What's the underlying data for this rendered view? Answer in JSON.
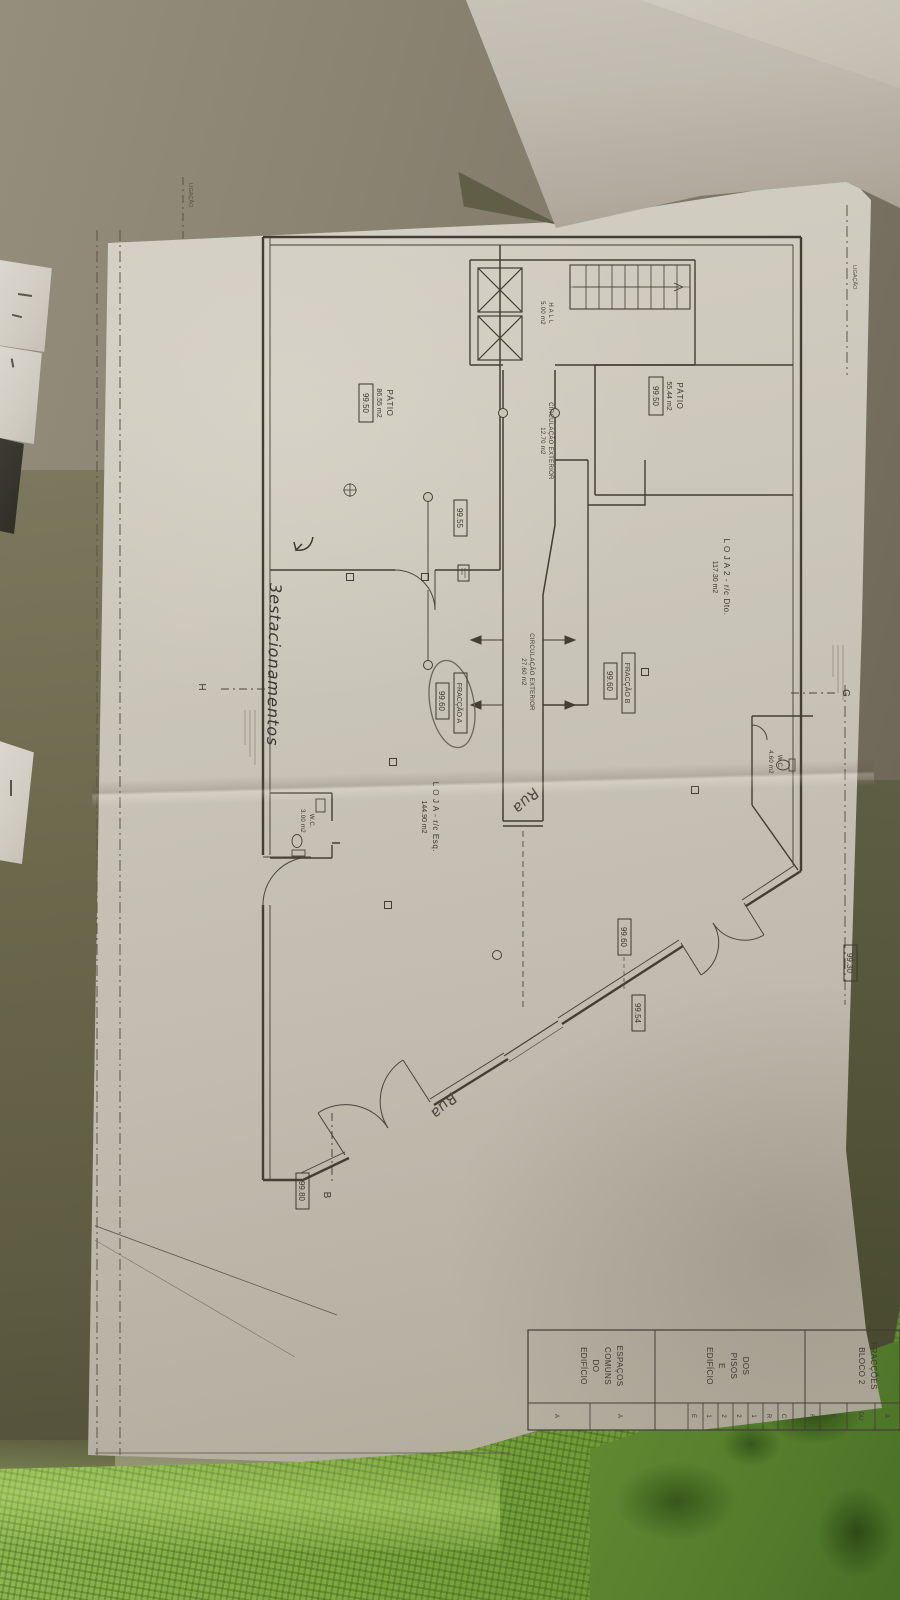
{
  "rooms": {
    "patio_top": {
      "name": "PÁTIO",
      "area": "55.44 m2",
      "level": "99.50"
    },
    "patio_left": {
      "name": "PÁTIO",
      "area": "86.55 m2",
      "level": "99.50"
    },
    "loja2": {
      "name": "L O J A 2 - r/c Dto.",
      "area": "117.30 m2"
    },
    "loja": {
      "name": "L O J A - r/c Esq.",
      "area": "144.90 m2"
    },
    "circulacao_1": {
      "name": "CIRCULAÇÃO EXTERIOR",
      "area": "12.70 m2"
    },
    "circulacao_2": {
      "name": "CIRCULAÇÃO EXTERIOR",
      "area": "27.60 m2"
    },
    "hall": {
      "name": "H A L L",
      "area": "5.00 m2"
    },
    "wc_right": {
      "name": "W.C.",
      "area": "4.60 m2"
    },
    "wc_left": {
      "name": "W.C.",
      "area": "3.00 m2"
    }
  },
  "fractions": {
    "a": {
      "label": "FRACÇÃO A",
      "level": "99.60"
    },
    "b": {
      "label": "FRACÇÃO B",
      "level": "99.60"
    }
  },
  "spot_levels": {
    "corridor": "99.55",
    "door": "99.60",
    "street": "99.54",
    "corner": "99.80",
    "top": "99.30"
  },
  "section_markers": {
    "g": "G",
    "h": "H",
    "b": "B"
  },
  "axis_labels": {
    "left": "LIGAÇÃO",
    "top": "LIGAÇÃO"
  },
  "handwriting": {
    "parking": "3estacionamentos",
    "street_1": "Rua",
    "street_2": "Rua"
  },
  "title_block": {
    "fraccoes": [
      "FRACÇÕES",
      "BLOCO 2"
    ],
    "pisos": [
      "DOS",
      "PISOS",
      "E",
      "EDIFÍCIO"
    ],
    "espacos": [
      "ESPAÇOS",
      "COMUNS",
      "DO",
      "EDIFÍCIO"
    ],
    "small_letters": [
      "C",
      "R",
      "1",
      "2",
      "2",
      "1",
      "E"
    ],
    "wide_letters": [
      "A",
      "A"
    ],
    "side_letters": [
      "A",
      "DU",
      "F",
      "F"
    ]
  }
}
